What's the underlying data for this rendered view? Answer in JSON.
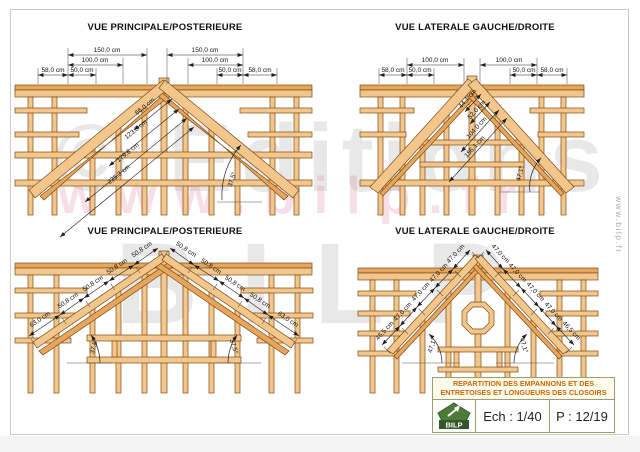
{
  "page": {
    "watermark": {
      "line1": "© Editions",
      "line2": "BILP",
      "url_watermark": "www.bilp.fr"
    },
    "side_url": "www.bilp.fr"
  },
  "views": {
    "top_left": {
      "title": "VUE PRINCIPALE/POSTERIEURE",
      "dims_top": [
        "150,0 cm",
        "150,0 cm",
        "100,0 cm",
        "100,0 cm",
        "58,0 cm",
        "50,0 cm",
        "50,0 cm",
        "58,0 cm"
      ],
      "dims_diag": [
        "66,0 cm",
        "123,8 cm",
        "179,6 cm",
        "235,3 cm"
      ],
      "angle": "37,5°"
    },
    "top_right": {
      "title": "VUE LATERALE GAUCHE/DROITE",
      "dims_top": [
        "100,0 cm",
        "100,0 cm",
        "58,0 cm",
        "50,0 cm",
        "50,0 cm",
        "58,0 cm"
      ],
      "dims_diag": [
        "44,1 cm",
        "52,0 cm",
        "104,0 cm",
        "156,1 cm"
      ],
      "angle": "47,1°"
    },
    "bottom_left": {
      "title": "VUE PRINCIPALE/POSTERIEURE",
      "rafter_left": [
        "63,0 cm",
        "50,8 cm",
        "50,8 cm",
        "50,8 cm",
        "50,8 cm"
      ],
      "rafter_right": [
        "50,8 cm",
        "50,8 cm",
        "50,8 cm",
        "50,8 cm",
        "63,0 cm"
      ],
      "angle_left": "37,5°",
      "angle_right": "37,5°"
    },
    "bottom_right": {
      "title": "VUE LATERALE GAUCHE/DROITE",
      "rafter_left": [
        "46,5 cm",
        "47,0 cm",
        "47,0 cm",
        "47,0 cm",
        "47,0 cm"
      ],
      "rafter_right": [
        "47,0 cm",
        "47,0 cm",
        "47,0 cm",
        "47,0 cm",
        "46,5 cm"
      ],
      "angle_left": "47,1°",
      "angle_right": "47,1°"
    }
  },
  "title_block": {
    "line1": "REPARTITION DES EMPANNONS ET DES",
    "line2": "ENTRETOISES ET LONGUEURS DES CLOSOIRS",
    "logo": "BILP",
    "scale": "Ech : 1/40",
    "page": "P : 12/19"
  },
  "colors": {
    "wood": "#f3c78b",
    "wood_dark": "#e6a75d",
    "accent": "#cc6600",
    "logo_green": "#4d7c3a"
  }
}
